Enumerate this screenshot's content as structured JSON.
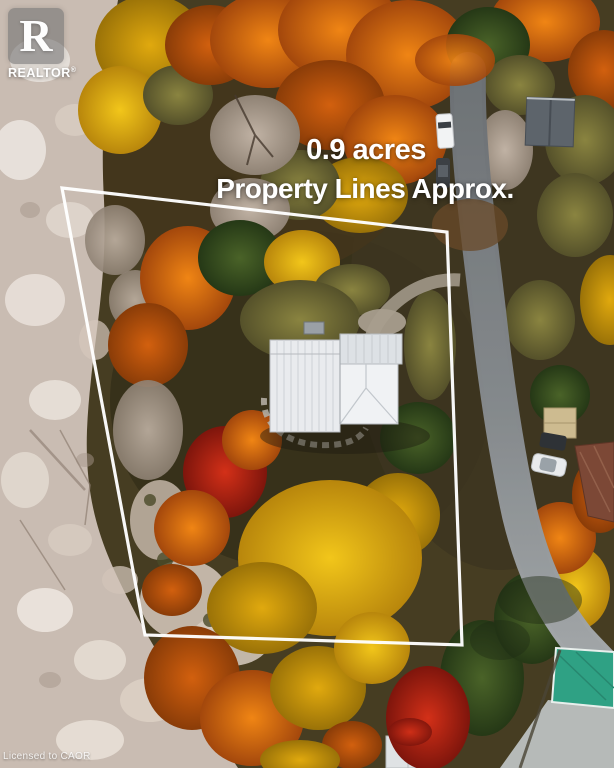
{
  "overlay": {
    "acreage_text": "0.9 acres",
    "disclaimer_text": "Property Lines Approx.",
    "text_color": "#ffffff"
  },
  "logo": {
    "letter": "R",
    "label": "REALTOR",
    "registered_mark": "®"
  },
  "watermark": {
    "text": "Licensed to CAOR"
  },
  "scene": {
    "description": "Aerial drone photo of a treed 0.9 acre lot in autumn: white metal-roof house at centre, white property-line polygon, grey road curving along the right, pale rocky shoreline strip on the left",
    "property_line_points": "62,188 447,232 462,645 145,635",
    "colors": {
      "property_line": "#ffffff",
      "road": "#7e8184",
      "rock_strip": "#c9bcb2",
      "foliage_orange": "#d96a10",
      "foliage_yellow": "#e3b90e",
      "foliage_red": "#c02012",
      "foliage_green": "#3c5224",
      "house_roof": "#e9ebee",
      "teal_roof": "#2fa184"
    }
  }
}
